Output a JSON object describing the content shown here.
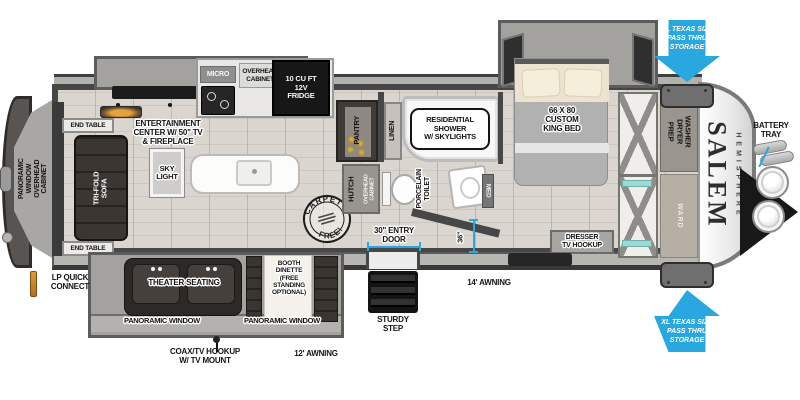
{
  "brand": {
    "main": "SALEM",
    "sub": "HEMISPHERE"
  },
  "callouts": {
    "pass_thru_top": "XL TEXAS SIZE\nPASS THRU\nSTORAGE",
    "pass_thru_bottom": "XL TEXAS SIZE\nPASS THRU\nSTORAGE",
    "battery_tray": "BATTERY\nTRAY",
    "lp_quick_connect": "LP QUICK\nCONNECT",
    "coax_tv_hookup": "COAX/TV HOOKUP\nW/ TV MOUNT",
    "awning_12": "12' AWNING",
    "awning_14": "14' AWNING",
    "sturdy_step": "STURDY\nSTEP",
    "entry_door": "30\" ENTRY\nDOOR",
    "dim_36": "36\""
  },
  "living": {
    "rear_cabinet": "PANORAMIC WINDOW\nOVERHEAD CABINET",
    "end_table_top": "END TABLE",
    "end_table_bottom": "END TABLE",
    "sofa": "TRI-FOLD\nSOFA",
    "entertainment": "ENTERTAINMENT\nCENTER W/ 50\" TV\n& FIREPLACE",
    "sky_light": "SKY\nLIGHT",
    "carpet_top": "CARPET",
    "carpet_bottom": "FREE!",
    "theater_seating": "THEATER SEATING",
    "booth_dinette": "BOOTH\nDINETTE\n(FREE\nSTANDING\nOPTIONAL)",
    "panoramic_window_left": "PANORAMIC WINDOW",
    "panoramic_window_right": "PANORAMIC WINDOW"
  },
  "kitchen": {
    "micro": "MICRO",
    "overhead_cabinet": "OVERHEAD\nCABINET",
    "fridge": "10 CU FT\n12V\nFRIDGE",
    "pantry": "PANTRY",
    "hutch": "HUTCH",
    "hutch_overhead_cabinet": "OVERHEAD\nCABINET"
  },
  "bathroom": {
    "linen": "LINEN",
    "shower": "RESIDENTIAL\nSHOWER\nW/ SKYLIGHTS",
    "toilet": "PORCELAIN\nTOILET",
    "med_cabinet": "MED"
  },
  "bedroom": {
    "bed": "66 X 80\nCUSTOM\nKING BED",
    "dresser": "DRESSER\nTV HOOKUP",
    "washer_dryer_prep": "WASHER\nDRYER\nPREP",
    "wardrobe": "WARD"
  },
  "colors": {
    "callout_blue": "#29a8e0",
    "wall_dark": "#474747",
    "slide_gray": "#a4a29e",
    "furniture_dark": "#332e2c",
    "floor": "#d7d3cc",
    "fridge_black": "#171717",
    "lp_orange": "#d9882f"
  }
}
